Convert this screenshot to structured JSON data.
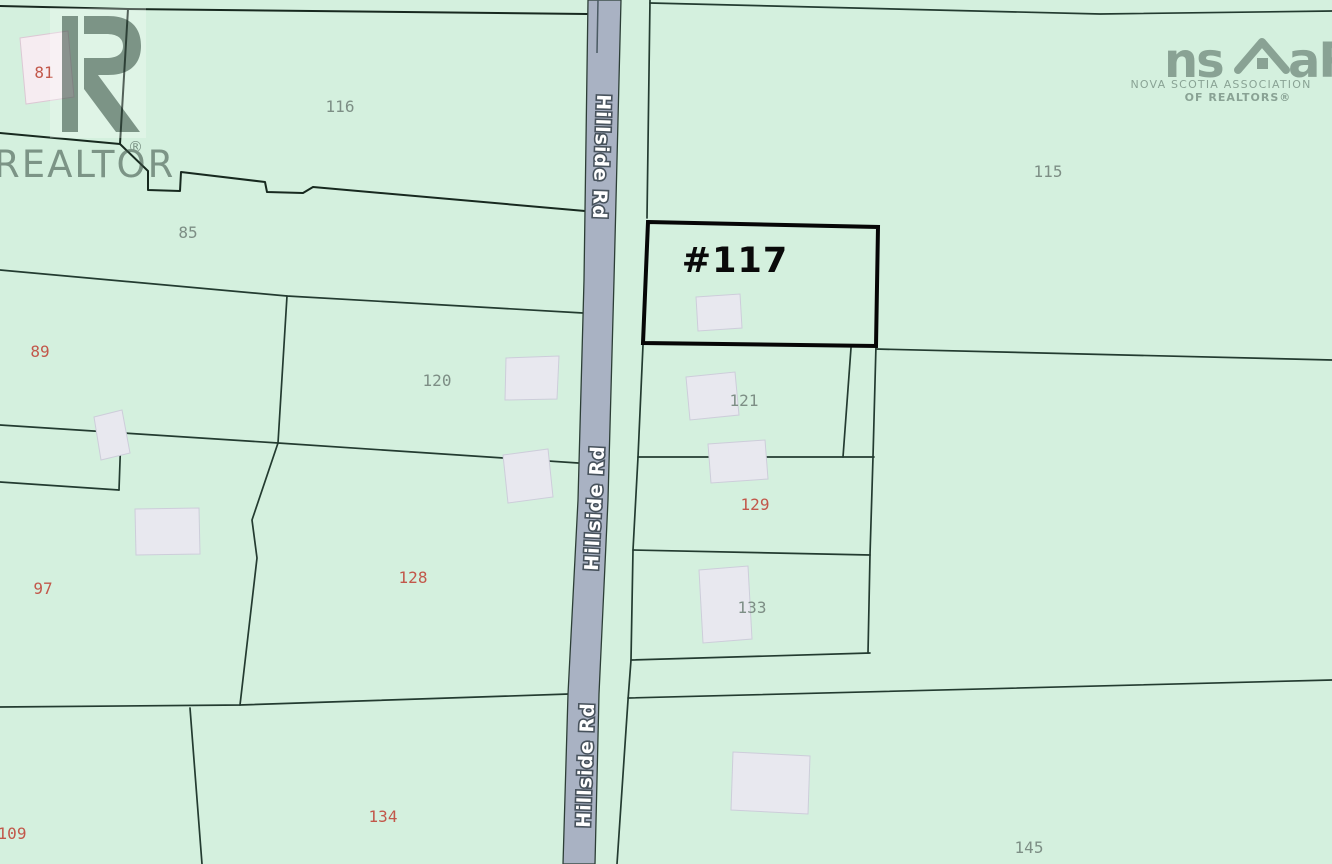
{
  "map": {
    "type": "cadastral-parcel-map",
    "background_color": "#d4f0de",
    "road": {
      "name": "Hillside Rd",
      "fill_color": "#a9b2c3",
      "label_color": "#ffffff",
      "label_outline_color": "#47525c"
    },
    "highlighted_parcel": {
      "label": "#117",
      "outline_color": "#060606"
    },
    "label_colors": {
      "gray": "#7d8e85",
      "red": "#c2574a"
    },
    "parcel_labels": [
      {
        "text": "81",
        "style": "red"
      },
      {
        "text": "116",
        "style": "gray"
      },
      {
        "text": "85",
        "style": "gray"
      },
      {
        "text": "89",
        "style": "red"
      },
      {
        "text": "115",
        "style": "gray"
      },
      {
        "text": "120",
        "style": "gray"
      },
      {
        "text": "121",
        "style": "gray"
      },
      {
        "text": "129",
        "style": "red"
      },
      {
        "text": "97",
        "style": "red"
      },
      {
        "text": "128",
        "style": "red"
      },
      {
        "text": "133",
        "style": "gray"
      },
      {
        "text": "109",
        "style": "red"
      },
      {
        "text": "134",
        "style": "red"
      },
      {
        "text": "145",
        "style": "gray"
      }
    ],
    "logos": {
      "realtor": {
        "word": "REALTOR",
        "registered_mark": "®"
      },
      "nsar": {
        "left": "ns",
        "right": "aR",
        "line1": "NOVA SCOTIA ASSOCIATION",
        "line2": "OF REALTORS®"
      }
    }
  }
}
